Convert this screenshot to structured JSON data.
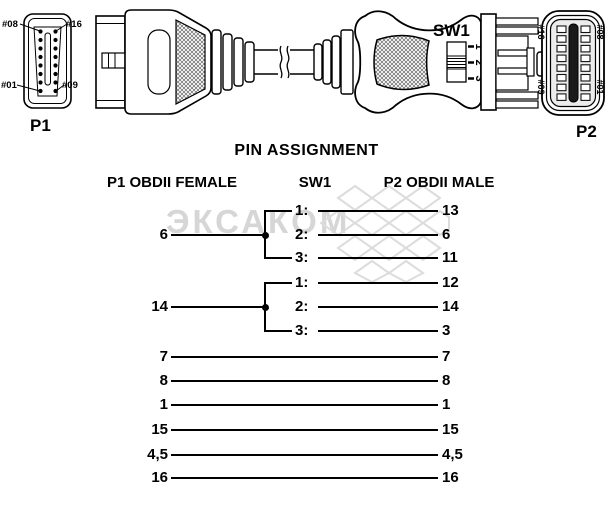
{
  "watermark": {
    "text": "ЭКСАКОМ"
  },
  "connector_diagram": {
    "p1": {
      "label": "P1",
      "pins": {
        "top_left": "#08",
        "top_right": "#16",
        "bottom_left": "#01",
        "bottom_right": "#09"
      }
    },
    "p2": {
      "label": "P2",
      "pins": {
        "top_left": "#16",
        "top_right": "#08",
        "bottom_left": "#09",
        "bottom_right": "#01"
      }
    },
    "sw1": {
      "label": "SW1",
      "positions": [
        "1",
        "2",
        "3"
      ]
    }
  },
  "pin_assignment": {
    "title": "PIN ASSIGNMENT",
    "columns": {
      "left": "P1 OBDII FEMALE",
      "middle": "SW1",
      "right": "P2 OBDII MALE"
    },
    "switch_groups": [
      {
        "p1_pin": "6",
        "rows": [
          {
            "sw": "1:",
            "p2_pin": "13"
          },
          {
            "sw": "2:",
            "p2_pin": "6"
          },
          {
            "sw": "3:",
            "p2_pin": "11"
          }
        ]
      },
      {
        "p1_pin": "14",
        "rows": [
          {
            "sw": "1:",
            "p2_pin": "12"
          },
          {
            "sw": "2:",
            "p2_pin": "14"
          },
          {
            "sw": "3:",
            "p2_pin": "3"
          }
        ]
      }
    ],
    "direct_rows": [
      {
        "p1_pin": "7",
        "p2_pin": "7"
      },
      {
        "p1_pin": "8",
        "p2_pin": "8"
      },
      {
        "p1_pin": "1",
        "p2_pin": "1"
      },
      {
        "p1_pin": "15",
        "p2_pin": "15"
      },
      {
        "p1_pin": "4,5",
        "p2_pin": "4,5"
      },
      {
        "p1_pin": "16",
        "p2_pin": "16"
      }
    ]
  },
  "colors": {
    "line": "#000000",
    "watermark": "#d6d6d6",
    "background": "#ffffff"
  }
}
